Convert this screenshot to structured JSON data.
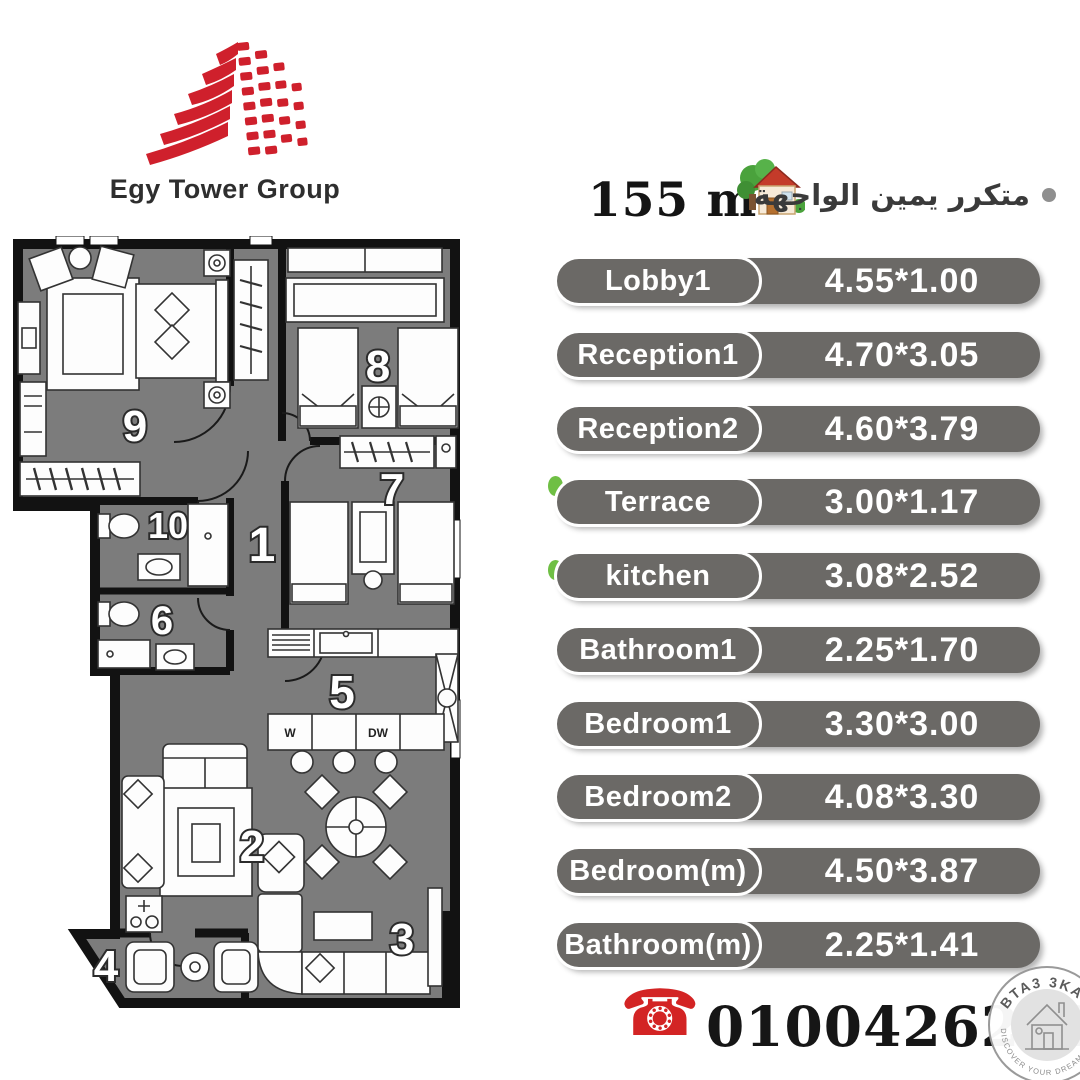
{
  "header": {
    "logo_title": "Egy Tower Group",
    "area_value": "155 m",
    "area_sup": "2",
    "arabic_note": "متكرر يمين الواجهة"
  },
  "table": {
    "rows": [
      {
        "name": "Lobby1",
        "dims": "4.55*1.00"
      },
      {
        "name": "Reception1",
        "dims": "4.70*3.05"
      },
      {
        "name": "Reception2",
        "dims": "4.60*3.79"
      },
      {
        "name": "Terrace",
        "dims": "3.00*1.17"
      },
      {
        "name": "kitchen",
        "dims": "3.08*2.52"
      },
      {
        "name": "Bathroom1",
        "dims": "2.25*1.70"
      },
      {
        "name": "Bedroom1",
        "dims": "3.30*3.00"
      },
      {
        "name": "Bedroom2",
        "dims": "4.08*3.30"
      },
      {
        "name": "Bedroom(m)",
        "dims": "4.50*3.87"
      },
      {
        "name": "Bathroom(m)",
        "dims": "2.25*1.41"
      }
    ]
  },
  "plan": {
    "rooms": {
      "r1": "1",
      "r2": "2",
      "r3": "3",
      "r4": "4",
      "r5": "5",
      "r6": "6",
      "r7": "7",
      "r8": "8",
      "r9": "9",
      "r10": "10"
    },
    "kitchen_labels": {
      "washer": "W",
      "dishwasher": "DW"
    }
  },
  "contact": {
    "phone_icon": "☎",
    "phone": "01004262626"
  },
  "watermark": {
    "top": "BTA3 3KAR",
    "bottom": "DISCOVER YOUR DREAM HOME"
  },
  "colors": {
    "brand_red": "#cf202c",
    "pill_gray": "#6b6966",
    "floor_gray": "#7c7c7c",
    "green_accent": "#6fbf44",
    "phone_red": "#d32424"
  }
}
